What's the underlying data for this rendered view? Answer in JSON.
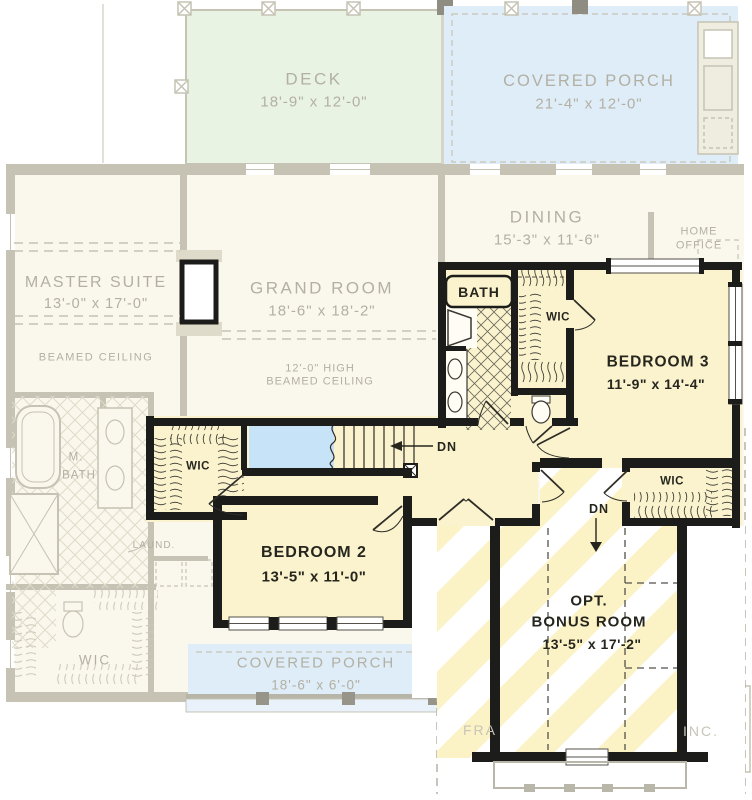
{
  "plan": {
    "colors": {
      "active_fill": "#FAF3CE",
      "active_text": "#26261F",
      "wall": "#1C1C1A",
      "ghost_fill": "#FAF7EC",
      "ghost_wall": "#C6C3B4",
      "ghost_line": "#C6C3B4",
      "ghost_text": "#B3B0A3",
      "deck_tint": "#E9F3E3",
      "porch_tint": "#DEEDF7",
      "open_below_tint": "#C7E3F7",
      "stripe": "#FBF2C6",
      "watermark": "#C8C5B8"
    },
    "first_floor_ghost": {
      "deck": {
        "name": "DECK",
        "dims": "18'-9\" x 12'-0\""
      },
      "covered_porch_upper": {
        "name": "COVERED PORCH",
        "dims": "21'-4\" x 12'-0\""
      },
      "dining": {
        "name": "DINING",
        "dims": "15'-3\" x 11'-6\""
      },
      "home_office": {
        "line1": "HOME",
        "line2": "OFFICE"
      },
      "master_suite": {
        "name": "MASTER SUITE",
        "dims": "13'-0\" x 17'-0\"",
        "ceiling_note": "BEAMED CEILING"
      },
      "grand_room": {
        "name": "GRAND ROOM",
        "dims": "18'-6\" x 18'-2\"",
        "ceiling_note_line1": "12'-0\" HIGH",
        "ceiling_note_line2": "BEAMED CEILING"
      },
      "master_bath": {
        "line1": "M.",
        "line2": "BATH"
      },
      "laundry": {
        "name": "LAUND."
      },
      "closet": {
        "name": "WIC"
      },
      "covered_porch_lower": {
        "name": "COVERED PORCH",
        "dims": "18'-6\" x 6'-0\""
      },
      "watermark_left": "FRA",
      "watermark_right": "INC."
    },
    "second_floor": {
      "bath": {
        "name": "BATH"
      },
      "bath_closet": {
        "name": "WIC"
      },
      "bedroom_3": {
        "name": "BEDROOM 3",
        "dims": "11'-9\" x 14'-4\""
      },
      "closet_left": {
        "name": "WIC"
      },
      "stairs_down": {
        "label": "DN"
      },
      "bedroom_2": {
        "name": "BEDROOM 2",
        "dims": "13'-5\" x 11'-0\""
      },
      "closet_right": {
        "name": "WIC"
      },
      "bonus_stairs_down": {
        "label": "DN"
      },
      "bonus_room": {
        "line1": "OPT.",
        "line2": "BONUS ROOM",
        "dims": "13'-5\" x 17'-2\""
      }
    }
  }
}
